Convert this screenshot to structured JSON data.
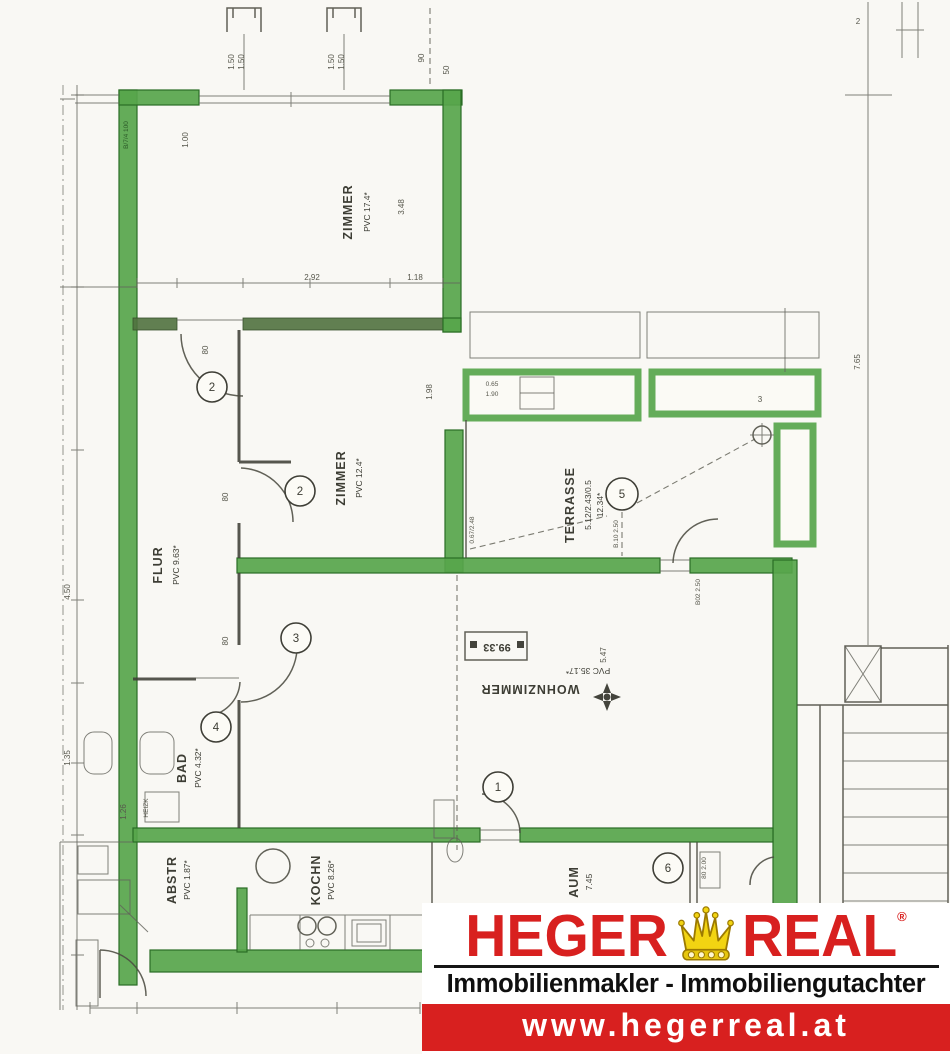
{
  "colors": {
    "wall_highlight": "#57a54b",
    "drawing_line": "#4b4b41",
    "logo_red": "#d8201f",
    "crown_gold": "#f2d412",
    "url_text": "#ffffff"
  },
  "logo": {
    "brand_left": "HEGER",
    "brand_right": "REAL",
    "registered": "®",
    "icon": "crown",
    "tagline": "Immobilienmakler - Immobiliengutachter",
    "website": "www.hegerreal.at"
  },
  "rooms": {
    "zimmer1": {
      "name": "ZIMMER",
      "detail": "PVC 17.4*"
    },
    "zimmer2": {
      "name": "ZIMMER",
      "detail": "PVC 12.4*"
    },
    "flur": {
      "name": "FLUR",
      "detail": "PVC 9.63*"
    },
    "terrasse": {
      "name": "TERRASSE",
      "detail": "5.12/2.43/0.5",
      "area": "12.34*"
    },
    "wohnzimmer": {
      "name": "WOHNZIMMER",
      "detail": "PVC 35.17*"
    },
    "bad": {
      "name": "BAD",
      "detail": "PVC 4.32*"
    },
    "abstellraum": {
      "name": "ABSTR",
      "detail": "PVC 1.87*"
    },
    "kueche": {
      "name": "KOCHN",
      "detail": "PVC 8.26*"
    },
    "vorraum": {
      "name": "AUM",
      "detail": "7.45"
    }
  },
  "doors": {
    "c1": "2",
    "c2": "2",
    "c3": "3",
    "c4": "4",
    "c5": "5",
    "c6": "1",
    "c7": "6"
  },
  "dimensions": {
    "top_marker_a1": "1.50",
    "top_marker_a2": "1.50",
    "top_marker_b1": "1.50",
    "top_marker_b2": "1.50",
    "top_c": "90",
    "top_d": "50",
    "z1_left": "1.00",
    "z1_right": "3.48",
    "z1_bottom_a": "2.92",
    "z1_bottom_b": "1.18",
    "z2_right": "1.98",
    "door_a": "80",
    "door_b": "80",
    "door_c": "80",
    "right_v": "7.65",
    "right_t": "2",
    "parapet_a": "0.65",
    "parapet_b": "1.90",
    "parapet_c": "3",
    "terr_left": "0.67/2.48",
    "terr_mid": "B.10 2.50",
    "terr_door": "B02 2.50",
    "wz_center": "5.47",
    "left_a": "4.50",
    "left_b": "1.35",
    "left_c": "1.26",
    "wall_note": "B/7/4 100",
    "door7_w": "80 2.00"
  },
  "annotations": {
    "area_box": "99.33",
    "radiator": "HEIZK"
  }
}
